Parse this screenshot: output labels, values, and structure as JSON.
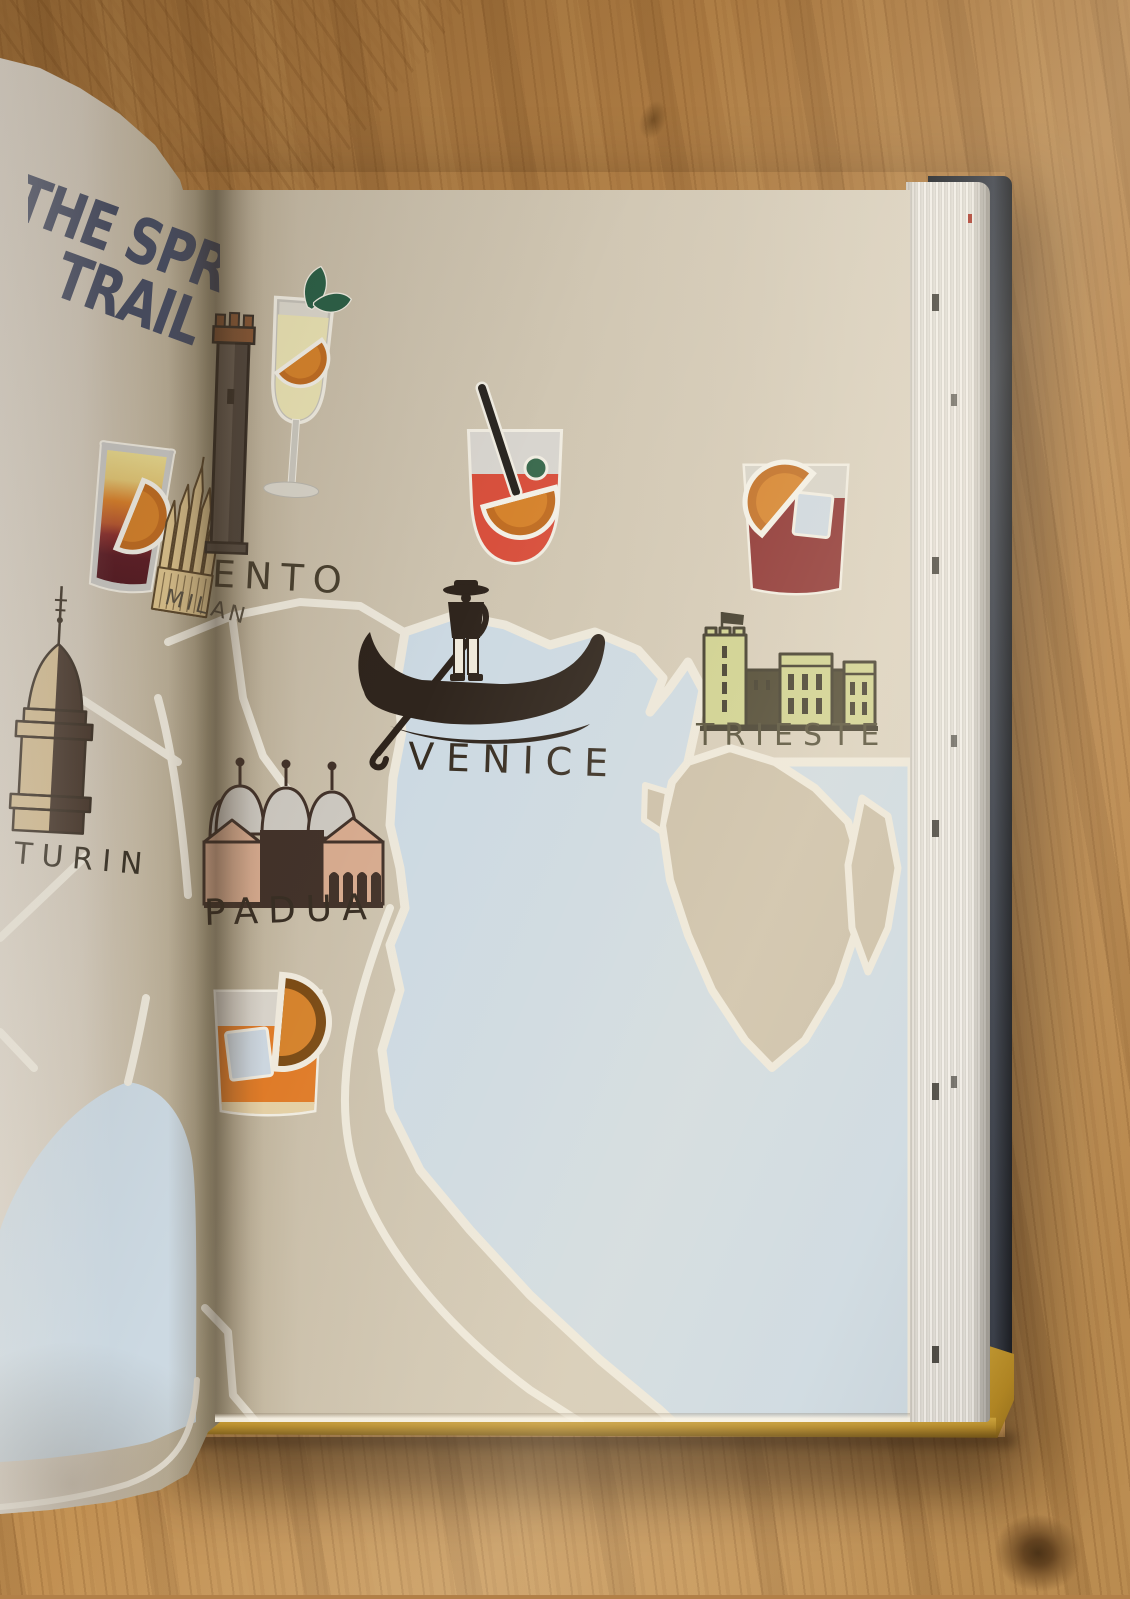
{
  "photo": {
    "title": {
      "line1": "THE SPRITZ",
      "line2": "TRAIL",
      "color": "#4b5166"
    },
    "map_labels": {
      "turin": "TURIN",
      "milan": "MILAN",
      "trento_partial": "ENTO",
      "venice": "VENICE",
      "padua": "PADUA",
      "trieste": "TRIESTE"
    },
    "icons": [
      "layered-shot-glass-icon",
      "hugo-spritz-glass-icon",
      "venice-spritz-glass-icon",
      "negroni-glass-icon",
      "aperol-rocks-glass-icon",
      "gondola-icon",
      "mole-antonelliana-icon",
      "milan-duomo-icon",
      "trento-tower-icon",
      "padua-basilica-icon",
      "trieste-castle-icon"
    ],
    "colors": {
      "land_paper": "#cfc5b1",
      "sea": "#ccd9e2",
      "route": "#ece7da",
      "title_ink": "#4b5166",
      "label_ink": "#392f24",
      "spritz_red": "#d8503d",
      "negroni_red": "#8c3231",
      "aperol_orange": "#df7b28",
      "castle_green": "#cdd08d",
      "cover_navy": "#2b303a",
      "cover_yellow": "#c59b2d",
      "wood": "#b5834a"
    }
  }
}
